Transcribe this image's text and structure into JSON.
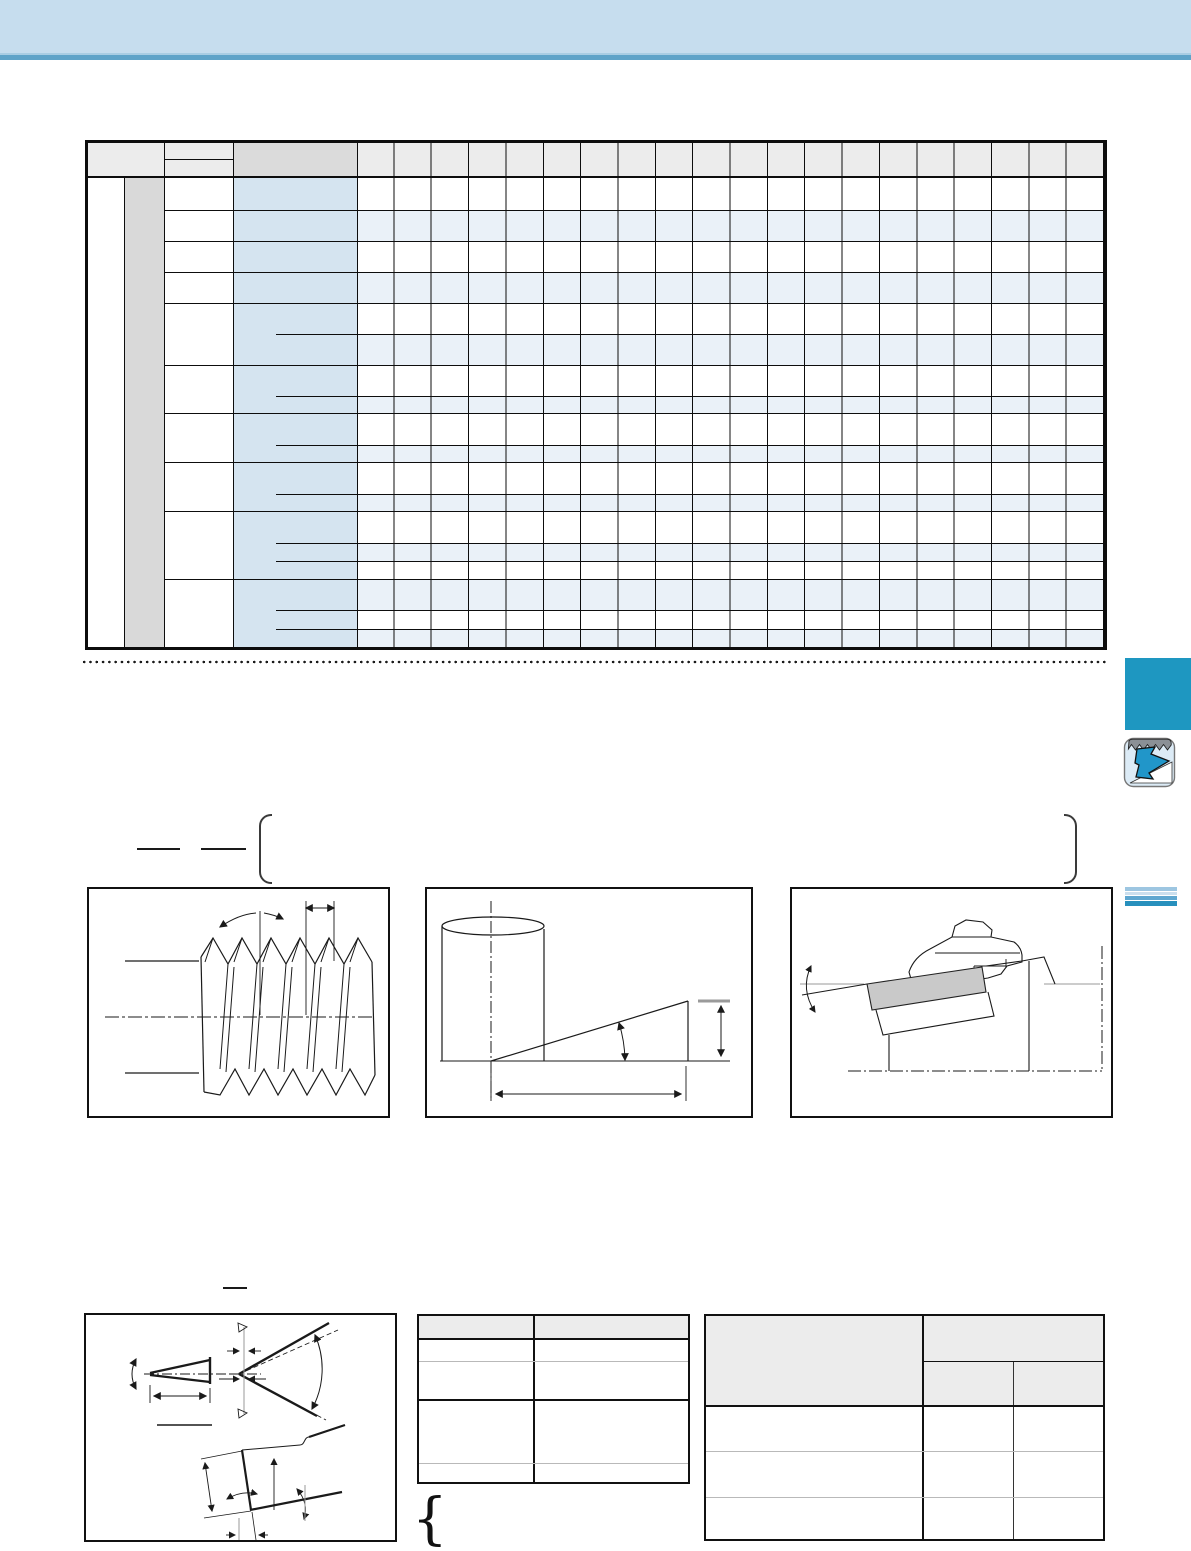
{
  "page": {
    "kind": "catalog-page-threading",
    "background": "#ffffff",
    "visible_text": ""
  },
  "top_banner": {
    "fill": "#c6ddee",
    "accent_line_fill": "#5fa3c8",
    "thin_line_fill": "#a9cde3"
  },
  "main_table": {
    "data_columns": 20,
    "body_rows": 18,
    "row_groups": 10,
    "header_fill": "#ececec",
    "designation_header_fill": "#dbdbdb",
    "left_gray_band_fill": "#d9d9d9",
    "designation_column_fill": "#d5e4f0",
    "alt_row_fill": "#eaf1f8",
    "border_color": "#0d0d0d"
  },
  "separator": {
    "style": "dotted",
    "dot_color": "#1a1a1a"
  },
  "side_elements": {
    "section_tab_fill": "#1e97c1",
    "thread_icon_body_fill": "#dcebf6",
    "thread_icon_arrow_fill": "#2196c9",
    "thread_icon_serration_fill": "#8b9096",
    "stripe_colors": [
      "#9dc6e1",
      "#cbdfee",
      "#5fa7d0",
      "#2890bd"
    ]
  },
  "formula_area": {
    "fraction_bars": 2,
    "bracket_color": "#3a3a3a"
  },
  "figures": {
    "fig1": "thread-profile-side-view",
    "fig2": "helix-angle-development",
    "fig3": "toolholder-insert-side-view",
    "fig4": "thread-form-angles",
    "line_color": "#1a1a1a",
    "insert_fill": "#c9c9c9",
    "centerline_style": "dash-dot"
  },
  "bottom_tables": {
    "middle": {
      "columns": 2,
      "rows": 4,
      "header_fill": "#ececec"
    },
    "right": {
      "columns": 3,
      "data_rows": 3,
      "header_fill": "#ececec",
      "header_tiers": 2
    }
  }
}
